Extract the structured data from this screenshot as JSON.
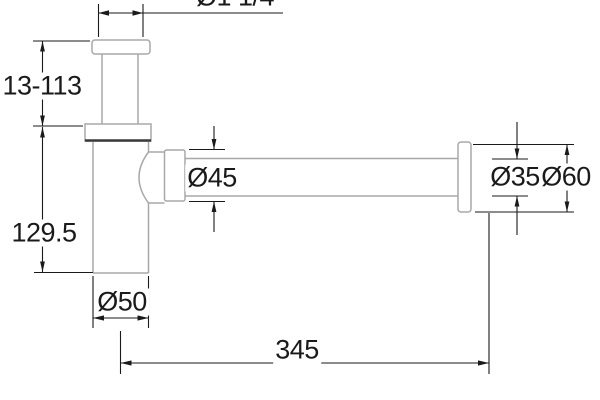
{
  "drawing": {
    "type": "technical-dimension-drawing",
    "subject": "bottle-trap-siphon",
    "colors": {
      "outline": "#a8a8a8",
      "joint_line": "#3a3a3a",
      "dimension": "#1a1a1a",
      "background": "#ffffff"
    },
    "labels": {
      "inlet_thread": "Ø1 1/4",
      "inlet_height_range": "13-113",
      "body_height": "129.5",
      "body_diameter": "Ø50",
      "nut_diameter": "Ø45",
      "pipe_diameter": "Ø35",
      "flange_diameter": "Ø60",
      "pipe_length": "345"
    }
  }
}
